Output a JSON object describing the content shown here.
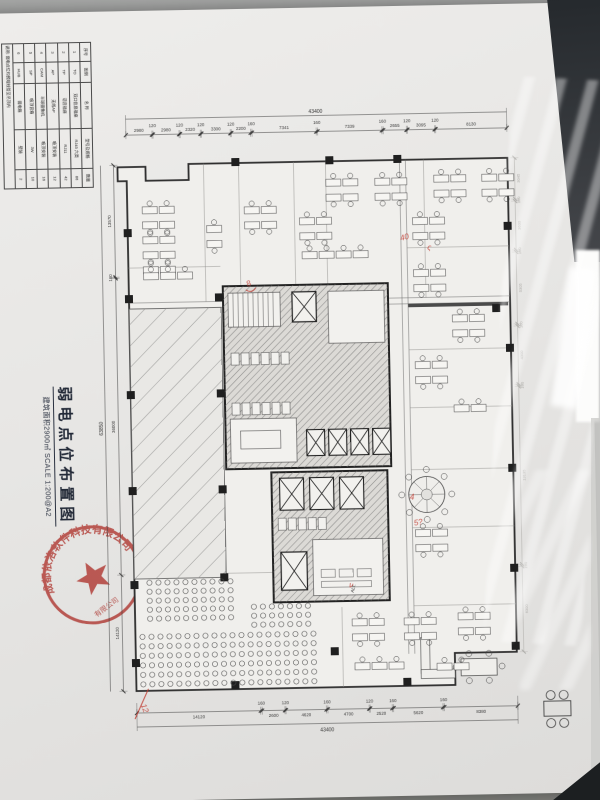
{
  "doc": {
    "title": "弱电点位布置图",
    "subtitle": "建筑面积2900㎡  SCALE 1:200@A2",
    "stamp_text": "成都依洛软件科技有限公司",
    "alt_label": "ALT."
  },
  "legend": {
    "header": [
      "序号",
      "图例",
      "名 称",
      "型号及规格",
      "数量"
    ],
    "rows": [
      [
        "1",
        "TO",
        "双口信息插座",
        "RJ45 六类",
        "86"
      ],
      [
        "2",
        "TP",
        "语音插座",
        "RJ11",
        "42"
      ],
      [
        "3",
        "AP",
        "无线AP",
        "吸顶安装",
        "12"
      ],
      [
        "4",
        "CAM",
        "半球摄像机",
        "吸顶安装",
        "16"
      ],
      [
        "5",
        "SP",
        "吸顶音箱",
        "3W",
        "10"
      ],
      [
        "6",
        "HUB",
        "弱电箱",
        "壁装",
        "2"
      ]
    ],
    "footer": "说明: 弱电点位均预埋线管至吊顶内"
  },
  "plan": {
    "dims": {
      "top_total": "43400",
      "top": [
        "2980",
        "120",
        "2980",
        "120",
        "2320",
        "120",
        "3300",
        "120",
        "2200",
        "160",
        "7341",
        "160",
        "7339",
        "160",
        "2655",
        "120",
        "3095",
        "120",
        "8130"
      ],
      "bottom": [
        "14120",
        "160",
        "2600",
        "120",
        "4620",
        "160",
        "4700",
        "120",
        "2520",
        "160",
        "5620",
        "160",
        "8380"
      ],
      "bottom_total": "43400",
      "left": [
        "13570",
        "160",
        "36000",
        "14120"
      ],
      "left_total": "63850",
      "right": [
        "3045",
        "160",
        "3600",
        "160",
        "5305",
        "160",
        "4300",
        "160",
        "13135",
        "160",
        "6300"
      ]
    },
    "clusters": [
      [
        48,
        104,
        5,
        2
      ],
      [
        48,
        170,
        1,
        3
      ],
      [
        112,
        124,
        2,
        1
      ],
      [
        150,
        106,
        2,
        2
      ],
      [
        205,
        118,
        2,
        2
      ],
      [
        232,
        80,
        2,
        2
      ],
      [
        281,
        80,
        2,
        2
      ],
      [
        340,
        78,
        2,
        2
      ],
      [
        388,
        78,
        2,
        2
      ],
      [
        207,
        152,
        1,
        4
      ],
      [
        318,
        120,
        2,
        2
      ],
      [
        318,
        172,
        2,
        2
      ],
      [
        356,
        218,
        2,
        2
      ],
      [
        318,
        264,
        2,
        2
      ],
      [
        356,
        308,
        1,
        2
      ],
      [
        315,
        432,
        2,
        2
      ],
      [
        250,
        520,
        2,
        2
      ],
      [
        302,
        520,
        2,
        2
      ],
      [
        356,
        516,
        2,
        2
      ],
      [
        252,
        564,
        1,
        3
      ],
      [
        334,
        566,
        1,
        2
      ]
    ],
    "audience": [
      [
        48,
        480,
        5,
        10,
        9,
        9
      ],
      [
        40,
        534,
        6,
        20,
        9,
        9.5
      ],
      [
        152,
        506,
        3,
        7,
        9,
        9
      ]
    ],
    "columns": [
      [
        29,
        126
      ],
      [
        29,
        192
      ],
      [
        29,
        288
      ],
      [
        29,
        384
      ],
      [
        29,
        478
      ],
      [
        29,
        556
      ],
      [
        119,
        192
      ],
      [
        119,
        288
      ],
      [
        119,
        384
      ],
      [
        119,
        472
      ],
      [
        138,
        57
      ],
      [
        232,
        57
      ],
      [
        300,
        57
      ],
      [
        409,
        126
      ],
      [
        409,
        248
      ],
      [
        409,
        368
      ],
      [
        409,
        468
      ],
      [
        409,
        546
      ],
      [
        228,
        548
      ],
      [
        128,
        580
      ],
      [
        300,
        580
      ],
      [
        396,
        208
      ]
    ],
    "marks": [
      {
        "t": "8",
        "x": 152,
        "y": 186,
        "r": -25
      },
      {
        "t": "40",
        "x": 306,
        "y": 143,
        "r": -15
      },
      {
        "t": "ς",
        "x": 332,
        "y": 152,
        "r": 10
      },
      {
        "t": "4",
        "x": 310,
        "y": 402,
        "r": 0
      },
      {
        "t": "5?",
        "x": 314,
        "y": 428,
        "r": -10
      },
      {
        "t": "ν",
        "x": 247,
        "y": 488,
        "r": 15
      },
      {
        "t": "12",
        "x": 37,
        "y": 602,
        "r": 70
      }
    ]
  }
}
